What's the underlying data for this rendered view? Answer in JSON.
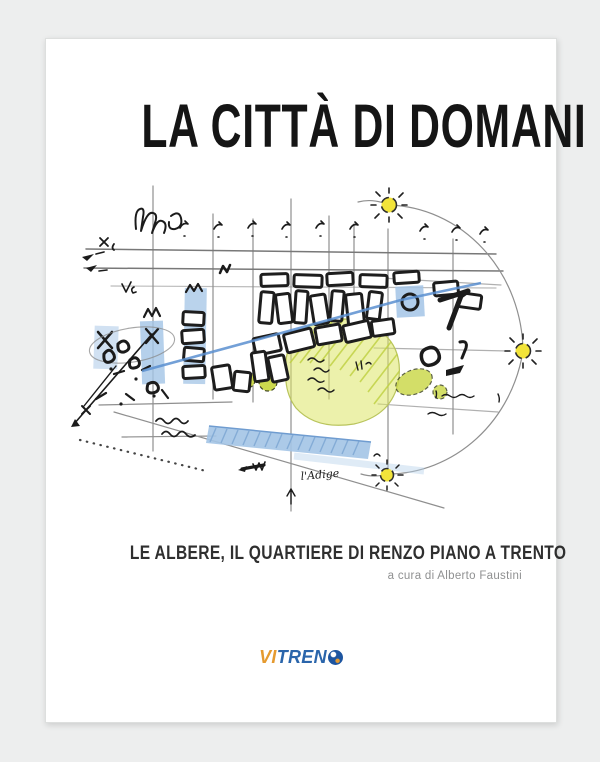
{
  "window": {
    "background": "#edeeee"
  },
  "cover": {
    "title": "LA CITTÀ DI DOMANI",
    "subtitle": "LE ALBERE, IL QUARTIERE DI RENZO PIANO A TRENTO",
    "curator_credit": "a cura di Alberto Faustini",
    "logo": {
      "text_orange": "VI",
      "text_blue": "TREN",
      "final_letter": "D",
      "orange_color": "#e59a2f",
      "blue_color": "#2a65ab",
      "globe_color": "#1d55a0"
    },
    "sketch": {
      "river_label": "l'Adige",
      "colors": {
        "ink": "#222222",
        "guide": "#8f8f8f",
        "blue_line": "#5b8fd0",
        "blue_fill": "#a3c4e6",
        "park_green": "#dce566",
        "tree_green": "#ccd94e",
        "sun_yellow": "#f2e43a"
      }
    }
  }
}
